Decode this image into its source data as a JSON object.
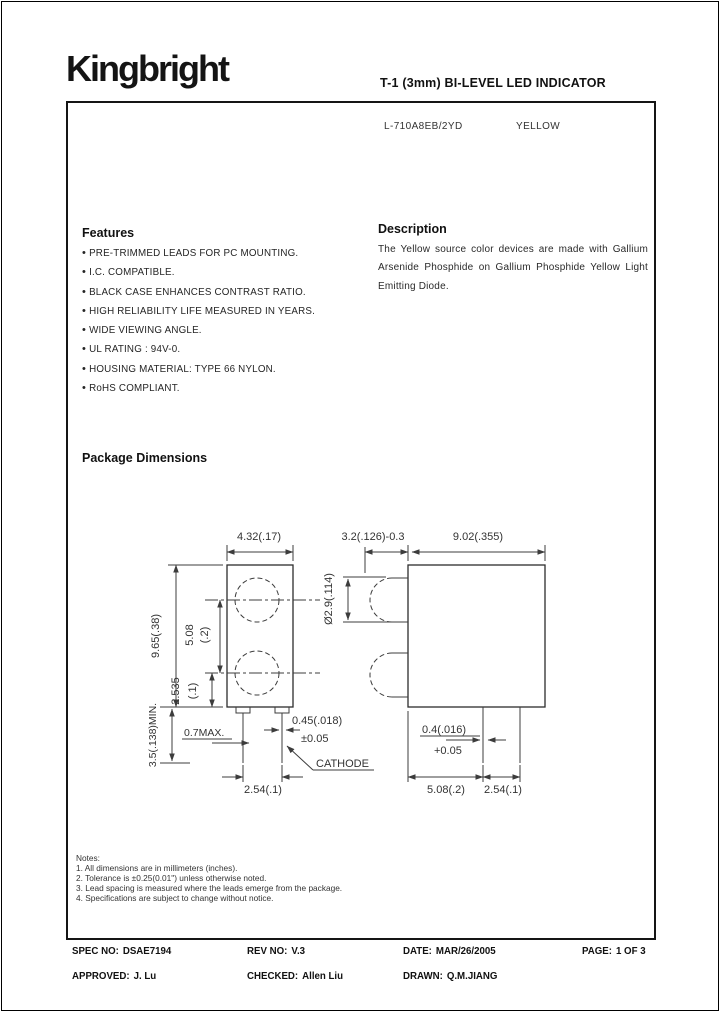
{
  "header": {
    "logo": "Kingbright",
    "title": "T-1 (3mm)  BI-LEVEL LED INDICATOR"
  },
  "part": {
    "number": "L-710A8EB/2YD",
    "color": "YELLOW"
  },
  "features": {
    "heading": "Features",
    "items": [
      "PRE-TRIMMED  LEADS  FOR  PC  MOUNTING.",
      "I.C. COMPATIBLE.",
      "BLACK CASE  ENHANCES  CONTRAST  RATIO.",
      "HIGH  RELIABILITY  LIFE  MEASURED  IN  YEARS.",
      "WIDE VIEWING ANGLE.",
      "UL RATING : 94V-0.",
      "HOUSING MATERIAL: TYPE 66 NYLON.",
      "RoHS COMPLIANT."
    ]
  },
  "description": {
    "heading": "Description",
    "text": "The Yellow source color devices are made with Gallium Arsenide Phosphide on Gallium Phosphide Yellow Light Emitting Diode."
  },
  "package": {
    "heading": "Package Dimensions"
  },
  "drawing": {
    "front": {
      "width": "4.32(.17)",
      "height": "9.65(.38)",
      "pitch_mm": "5.08",
      "pitch_in": "(.2)",
      "lower_mm": "2.535",
      "lower_in": "(.1)",
      "lead_min": "3.5(.138)MIN.",
      "standoff": "0.7MAX.",
      "thick1": "0.45(.018)",
      "thick2": "±0.05",
      "lead_pitch": "2.54(.1)",
      "cathode": "CATHODE"
    },
    "side": {
      "depth": "3.2(.126)-0.3",
      "width": "9.02(.355)",
      "lens_dia": "Ø2.9(.114)",
      "lead_w1": "0.4(.016)",
      "lead_w2": "+0.05",
      "dim_a": "5.08(.2)",
      "dim_b": "2.54(.1)"
    }
  },
  "notes": {
    "heading": "Notes:",
    "items": [
      "1. All dimensions are in millimeters (inches).",
      "2. Tolerance is ±0.25(0.01\") unless otherwise noted.",
      "3. Lead spacing is measured where the leads emerge from the package.",
      "4. Specifications are subject to change without notice."
    ]
  },
  "footer": {
    "spec": {
      "label": "SPEC NO:",
      "value": "DSAE7194"
    },
    "rev": {
      "label": "REV NO:",
      "value": "V.3"
    },
    "date": {
      "label": "DATE:",
      "value": "MAR/26/2005"
    },
    "page": {
      "label": "PAGE:",
      "value": "1 OF 3"
    },
    "approved": {
      "label": "APPROVED:",
      "value": "J. Lu"
    },
    "checked": {
      "label": "CHECKED:",
      "value": "Allen Liu"
    },
    "drawn": {
      "label": "DRAWN:",
      "value": "Q.M.JIANG"
    }
  }
}
